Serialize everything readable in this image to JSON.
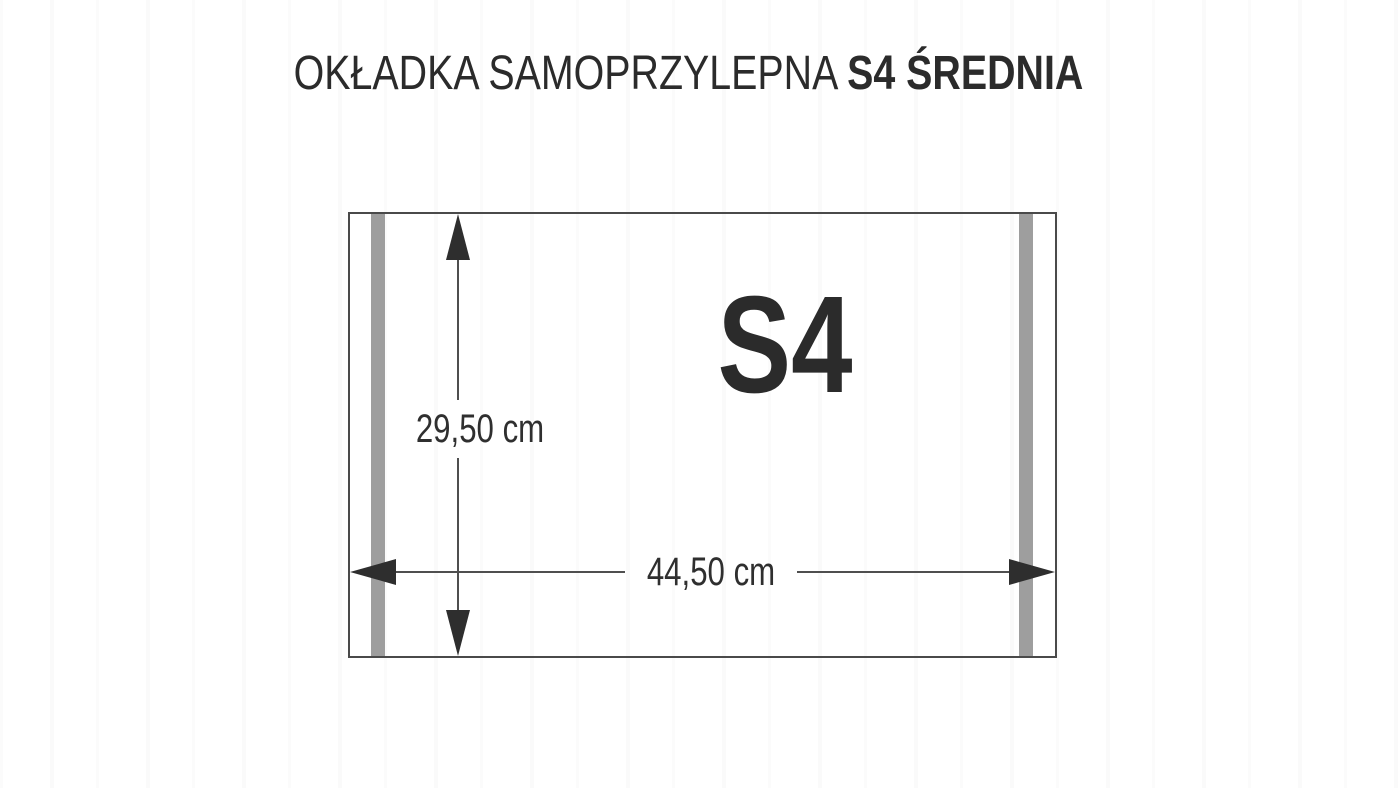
{
  "title": {
    "regular": "OKŁADKA SAMOPRZYLEPNA ",
    "bold": "S4 ŚREDNIA"
  },
  "diagram": {
    "size_label": "S4",
    "height_dimension": "29,50 cm",
    "width_dimension": "44,50 cm",
    "colors": {
      "background": "#ffffff",
      "title_text": "#2b2b2b",
      "outline": "#4a4a4a",
      "adhesive_stripe": "#9e9e9e",
      "dimension_line": "#4f4f4f",
      "arrowhead": "#2e2e2e",
      "dimension_text": "#2f2f2f"
    }
  }
}
